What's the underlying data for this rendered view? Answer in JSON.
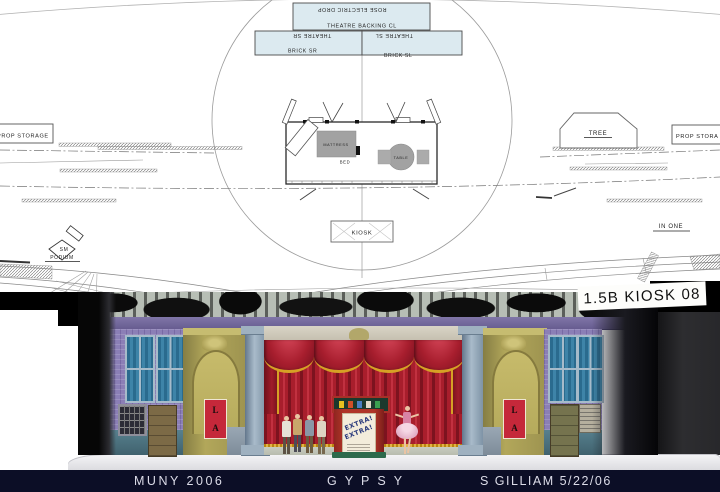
{
  "plan": {
    "backing_positions": {
      "rose_electric_drop": "ROSE ELECTRIC DROP",
      "theatre_backing_cl": "THEATRE BACKING CL",
      "theatre_sr": "THEATRE SR",
      "theatre_sl": "THEATRE SL",
      "brick_sr": "BRICK SR",
      "brick_sl": "BRICK SL"
    },
    "labels": {
      "prop_storage_left": "PROP STORAGE",
      "prop_storage_right": "PROP STORA",
      "tree": "TREE",
      "kiosk": "KIOSK",
      "sm": "SM",
      "podium": "PODIUM",
      "in_one": "IN ONE",
      "mattress": "MATTRESS",
      "bed": "BED",
      "table": "TABLE"
    },
    "sheet_title": "1.5B KIOSK 08"
  },
  "rendering": {
    "left_poster": {
      "line1": "L",
      "line2": "A"
    },
    "right_poster": {
      "line1": "L",
      "line2": "A"
    },
    "kiosk_poster": {
      "line1": "EXTRA!",
      "line2": "EXTRA!"
    }
  },
  "footer": {
    "venue": "MUNY 2006",
    "show": "GYPSY",
    "designer": "S GILLIAM 5/22/06"
  },
  "colors": {
    "footer_bg": "#0c0e26",
    "curtain_red": "#a81e2c",
    "wall_purple": "#8b7fb6",
    "wall_olive": "#a89a52",
    "poster_red": "#c5283a",
    "plan_box_fill": "#dceaf0"
  }
}
